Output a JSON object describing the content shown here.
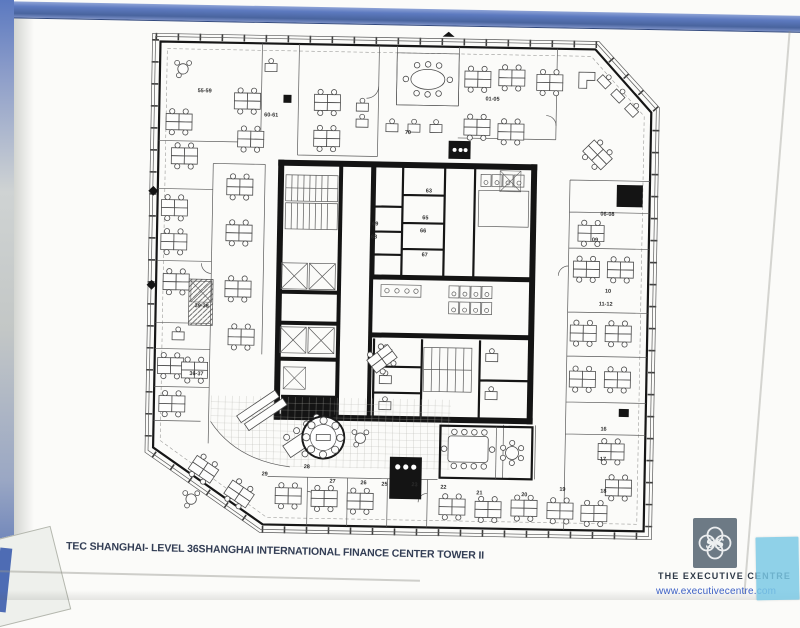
{
  "document": {
    "type": "scanned floor plan page in blue binder",
    "title": "TEC SHANGHAI- LEVEL 36SHANGHAI INTERNATIONAL FINANCE CENTER TOWER II"
  },
  "brand": {
    "name": "THE EXECUTIVE CENTRE",
    "website": "www.executivecentre.com",
    "logo_monogram": "SS",
    "logo_icon": "quatrefoil-knot-icon"
  },
  "colors": {
    "binder-blue": "#5577be",
    "paper": "#fbfbf9",
    "plan-ink": "#161616",
    "title-ink": "#333e55",
    "website-blue": "#3b5fc5",
    "logo-gray": "#6d7a85",
    "sticker-cyan": "#79c8e5"
  },
  "floorplan": {
    "level": "36",
    "building": "Shanghai International Finance Center Tower II",
    "room_labels": [
      {
        "text": "55-59",
        "x": 51,
        "y": 69
      },
      {
        "text": "60-61",
        "x": 118,
        "y": 92
      },
      {
        "text": "70",
        "x": 259,
        "y": 107
      },
      {
        "text": "01-05",
        "x": 339,
        "y": 72
      },
      {
        "text": "06-08",
        "x": 456,
        "y": 185
      },
      {
        "text": "09",
        "x": 448,
        "y": 211
      },
      {
        "text": "10",
        "x": 462,
        "y": 262
      },
      {
        "text": "11-12",
        "x": 456,
        "y": 275
      },
      {
        "text": "16",
        "x": 460,
        "y": 400
      },
      {
        "text": "17",
        "x": 460,
        "y": 430
      },
      {
        "text": "18",
        "x": 461,
        "y": 462
      },
      {
        "text": "19",
        "x": 420,
        "y": 461
      },
      {
        "text": "20",
        "x": 382,
        "y": 467
      },
      {
        "text": "21",
        "x": 337,
        "y": 466
      },
      {
        "text": "22",
        "x": 301,
        "y": 461
      },
      {
        "text": "23",
        "x": 272,
        "y": 459
      },
      {
        "text": "25",
        "x": 242,
        "y": 459
      },
      {
        "text": "26",
        "x": 221,
        "y": 458
      },
      {
        "text": "27",
        "x": 190,
        "y": 457
      },
      {
        "text": "28",
        "x": 164,
        "y": 443
      },
      {
        "text": "29",
        "x": 122,
        "y": 451
      },
      {
        "text": "39-38",
        "x": 52,
        "y": 284
      },
      {
        "text": "36-37",
        "x": 48,
        "y": 352
      },
      {
        "text": "63",
        "x": 281,
        "y": 165
      },
      {
        "text": "65",
        "x": 278,
        "y": 192
      },
      {
        "text": "66",
        "x": 276,
        "y": 205
      },
      {
        "text": "67",
        "x": 278,
        "y": 229
      },
      {
        "text": "69",
        "x": 228,
        "y": 199
      },
      {
        "text": "68",
        "x": 227,
        "y": 212
      }
    ]
  }
}
